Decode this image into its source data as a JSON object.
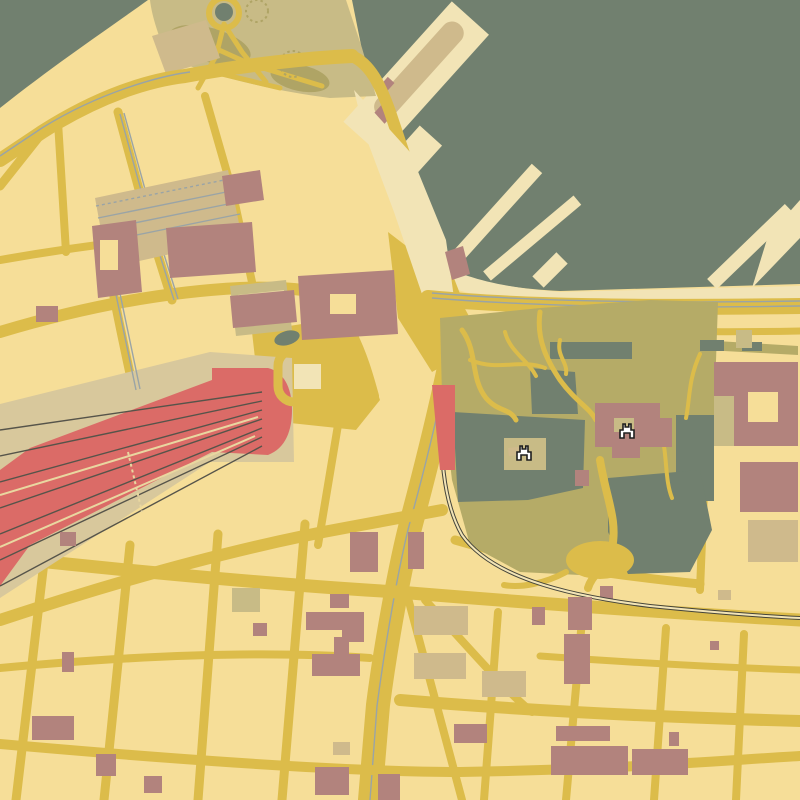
{
  "map": {
    "kind": "stylized-city-map",
    "visible_text": [],
    "layers": [
      {
        "name": "sea",
        "color_key": "water"
      },
      {
        "name": "land",
        "color_key": "land"
      },
      {
        "name": "harbor-piers",
        "color_key": "pale"
      },
      {
        "name": "roads",
        "color_key": "road"
      },
      {
        "name": "railway",
        "color_key": "rail"
      },
      {
        "name": "tram-lines",
        "color_key": "tram"
      },
      {
        "name": "central-station",
        "color_key": "station_red"
      },
      {
        "name": "parks",
        "color_key": "olive"
      },
      {
        "name": "ponds",
        "color_key": "water"
      },
      {
        "name": "buildings-mauve",
        "color_key": "mauve"
      },
      {
        "name": "buildings-tan",
        "color_key": "tan"
      },
      {
        "name": "buildings-khaki",
        "color_key": "khaki"
      }
    ]
  },
  "palette": {
    "water": "#71806F",
    "land": "#F6DE98",
    "pale": "#F2E4B6",
    "road": "#DCBC4A",
    "olive": "#B5AB67",
    "olive2": "#AFA465",
    "khaki": "#C8BB86",
    "tan": "#CFBA8C",
    "mauve": "#B2837D",
    "station_red": "#DB6B67",
    "platform": "#D8C89C",
    "rail": "#44443A",
    "track": "#56544A",
    "stripe": "#E9D7A0",
    "tram": "#9AA4A6",
    "icon_fill": "#FFFFFF",
    "icon_stroke": "#1E1E1E"
  },
  "icons": [
    {
      "name": "castle-icon",
      "transform": "translate(524,452)"
    },
    {
      "name": "castle-icon",
      "transform": "translate(627,430)"
    }
  ]
}
